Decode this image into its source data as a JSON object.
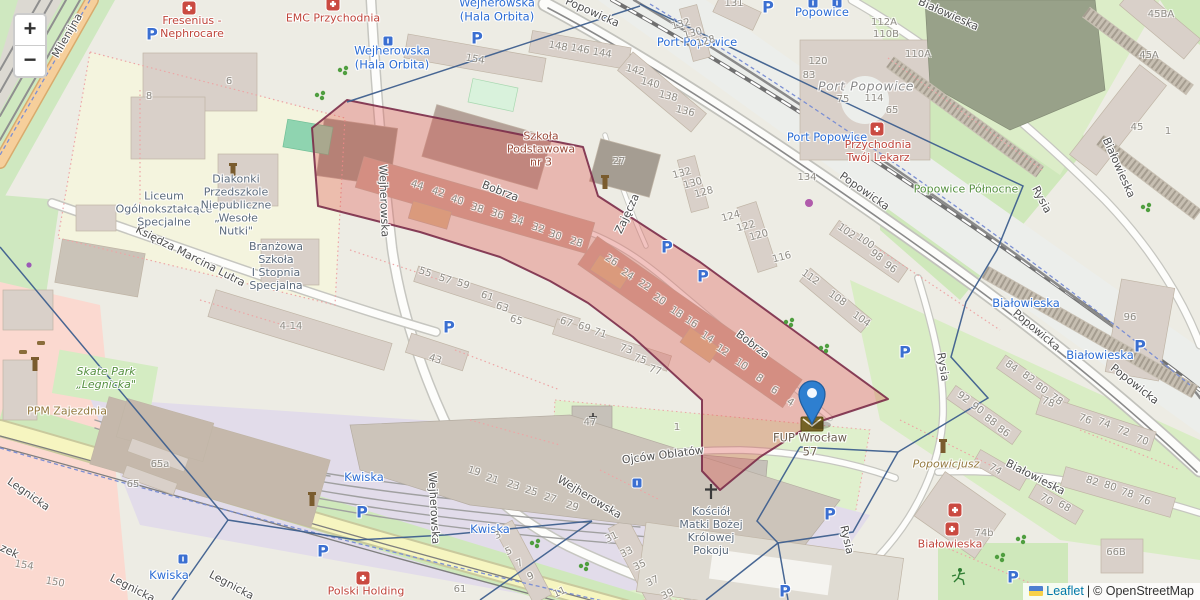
{
  "controls": {
    "zoom_in": "+",
    "zoom_out": "−"
  },
  "attribution": {
    "leaflet": "Leaflet",
    "separator": "|",
    "osm": "© OpenStreetMap"
  },
  "marker": {
    "label": "FUP Wrocław\n57",
    "x": 812,
    "y": 424
  },
  "colors": {
    "marker_blue": "#2e7fd0",
    "selection_fill": "#dd4f48",
    "selection_border": "#7b2c49",
    "zone_boundary": "#3e5f8e",
    "transit_blue": "#2b6cd4",
    "health_red": "#bf453b",
    "leaflet_link": "#0078A8"
  },
  "map": {
    "streets": [
      {
        "t": "Milenijna",
        "x": 68,
        "y": 36,
        "r": -60
      },
      {
        "t": "Wejherowska",
        "x": 383,
        "y": 201,
        "r": 88
      },
      {
        "t": "Wejherowska",
        "x": 433,
        "y": 508,
        "r": 87
      },
      {
        "t": "Wejherowska",
        "x": 589,
        "y": 498,
        "r": 31
      },
      {
        "t": "Księdza Marcina Lutra",
        "x": 190,
        "y": 257,
        "r": 27
      },
      {
        "t": "Bobrza",
        "x": 500,
        "y": 192,
        "r": 21
      },
      {
        "t": "Bobrza",
        "x": 752,
        "y": 345,
        "r": 37
      },
      {
        "t": "Zajęcza",
        "x": 628,
        "y": 214,
        "r": -65
      },
      {
        "t": "Popowicka",
        "x": 592,
        "y": 13,
        "r": 24
      },
      {
        "t": "Popowicka",
        "x": 864,
        "y": 192,
        "r": 35
      },
      {
        "t": "Popowicka",
        "x": 1036,
        "y": 331,
        "r": 40
      },
      {
        "t": "Popowicka",
        "x": 1134,
        "y": 385,
        "r": 38
      },
      {
        "t": "Białowieska",
        "x": 948,
        "y": 15,
        "r": 24
      },
      {
        "t": "Białowieska",
        "x": 1118,
        "y": 168,
        "r": 66
      },
      {
        "t": "Białowieska",
        "x": 1035,
        "y": 478,
        "r": 27
      },
      {
        "t": "Rysia",
        "x": 942,
        "y": 367,
        "r": 81
      },
      {
        "t": "Rysia",
        "x": 846,
        "y": 540,
        "r": 77
      },
      {
        "t": "Rysia",
        "x": 1041,
        "y": 200,
        "r": 62
      },
      {
        "t": "Ojców Oblatów",
        "x": 663,
        "y": 456,
        "r": -7
      },
      {
        "t": "Legnicka",
        "x": 28,
        "y": 495,
        "r": 35
      },
      {
        "t": "Legnicka",
        "x": 132,
        "y": 589,
        "r": 27
      },
      {
        "t": "Legnicka",
        "x": 231,
        "y": 586,
        "r": 28
      },
      {
        "t": "zek",
        "x": 9,
        "y": 552,
        "r": 25
      }
    ],
    "transit": [
      {
        "t": "Popowice",
        "x": 822,
        "y": 13
      },
      {
        "t": "Port Popowice",
        "x": 697,
        "y": 43
      },
      {
        "t": "Port Popowice",
        "x": 827,
        "y": 138
      },
      {
        "t": "Wejherowska\n(Hala Orbita)",
        "x": 392,
        "y": 58
      },
      {
        "t": "Wejherowska\n(Hala Orbita)",
        "x": 497,
        "y": 10
      },
      {
        "t": "Kwiska",
        "x": 364,
        "y": 478
      },
      {
        "t": "Kwiska",
        "x": 490,
        "y": 530
      },
      {
        "t": "Kwiska",
        "x": 169,
        "y": 576
      },
      {
        "t": "Białowieska",
        "x": 1026,
        "y": 304
      },
      {
        "t": "Białowieska",
        "x": 1100,
        "y": 356
      }
    ],
    "health": [
      {
        "t": "Fresenius -\nNephrocare",
        "x": 192,
        "y": 28
      },
      {
        "t": "EMC Przychodnia",
        "x": 333,
        "y": 19
      },
      {
        "t": "Przychodnia\nTwój Lekarz",
        "x": 878,
        "y": 152
      },
      {
        "t": "Polski Holding",
        "x": 366,
        "y": 592
      },
      {
        "t": "Białowieska",
        "x": 950,
        "y": 545
      }
    ],
    "education": [
      {
        "t": "Liceum\nOgólnokształcące\nSpecjalne",
        "x": 164,
        "y": 210
      },
      {
        "t": "Diakonki\nPrzedszkole\nNiepubliczne\n„Wesołe\nNutki\"",
        "x": 236,
        "y": 206
      },
      {
        "t": "Branżowa\nSzkoła\nI Stopnia\nSpecjalna",
        "x": 276,
        "y": 267
      }
    ],
    "places": [
      {
        "t": "Szkoła\nPodstawowa\nnr 3",
        "x": 541,
        "y": 150,
        "c": "edu-red"
      },
      {
        "t": "Kościół\nMatki Bożej\nKrólowej\nPokoju",
        "x": 711,
        "y": 532,
        "c": "edu"
      },
      {
        "t": "Port Popowice",
        "x": 866,
        "y": 87,
        "c": "hood",
        "i": 1
      },
      {
        "t": "Popowice Północne",
        "x": 966,
        "y": 190,
        "c": "green"
      },
      {
        "t": "Skate Park\n„Legnicka\"",
        "x": 106,
        "y": 379,
        "c": "green",
        "i": 1
      },
      {
        "t": "Popowicjusz",
        "x": 946,
        "y": 465,
        "c": "brown",
        "i": 1
      },
      {
        "t": "PPM Zajezdnia",
        "x": 67,
        "y": 412,
        "c": "brown"
      },
      {
        "t": "FUP Wrocław\n57",
        "x": 810,
        "y": 445,
        "c": "poi"
      }
    ],
    "numbers": [
      [
        "154",
        475,
        60,
        10
      ],
      [
        "148",
        558,
        47,
        10
      ],
      [
        "146",
        580,
        50,
        10
      ],
      [
        "144",
        602,
        54,
        10
      ],
      [
        "142",
        635,
        71,
        14
      ],
      [
        "140",
        650,
        84,
        14
      ],
      [
        "138",
        668,
        97,
        14
      ],
      [
        "136",
        685,
        112,
        14
      ],
      [
        "131",
        734,
        4,
        0
      ],
      [
        "132",
        681,
        25,
        -15
      ],
      [
        "130",
        693,
        34,
        -15
      ],
      [
        "128",
        706,
        42,
        -15
      ],
      [
        "132",
        682,
        174,
        -15
      ],
      [
        "130",
        693,
        184,
        -15
      ],
      [
        "128",
        704,
        193,
        -15
      ],
      [
        "124",
        731,
        217,
        -15
      ],
      [
        "122",
        746,
        227,
        -15
      ],
      [
        "120",
        759,
        236,
        -15
      ],
      [
        "116",
        782,
        258,
        -15
      ],
      [
        "112A",
        884,
        23,
        0
      ],
      [
        "110B",
        886,
        35,
        0
      ],
      [
        "110A",
        918,
        55,
        0
      ],
      [
        "120",
        818,
        62,
        0
      ],
      [
        "83",
        809,
        76,
        0
      ],
      [
        "75",
        843,
        100,
        0
      ],
      [
        "114",
        874,
        99,
        0
      ],
      [
        "65",
        892,
        111,
        0
      ],
      [
        "134",
        807,
        178,
        0
      ],
      [
        "27",
        619,
        162,
        0
      ],
      [
        "45BA",
        1161,
        15,
        0
      ],
      [
        "45A",
        1149,
        56,
        0
      ],
      [
        "45",
        1137,
        128,
        0
      ],
      [
        "1",
        1168,
        132,
        0
      ],
      [
        "44",
        417,
        186,
        18
      ],
      [
        "42",
        438,
        193,
        18
      ],
      [
        "40",
        457,
        201,
        18
      ],
      [
        "38",
        477,
        209,
        18
      ],
      [
        "36",
        497,
        215,
        18
      ],
      [
        "34",
        517,
        221,
        18
      ],
      [
        "32",
        538,
        229,
        18
      ],
      [
        "30",
        555,
        236,
        18
      ],
      [
        "28",
        576,
        243,
        18
      ],
      [
        "26",
        611,
        261,
        33
      ],
      [
        "24",
        627,
        275,
        33
      ],
      [
        "22",
        644,
        286,
        33
      ],
      [
        "20",
        659,
        300,
        33
      ],
      [
        "18",
        676,
        313,
        33
      ],
      [
        "16",
        691,
        323,
        33
      ],
      [
        "14",
        707,
        338,
        33
      ],
      [
        "12",
        722,
        351,
        33
      ],
      [
        "10",
        741,
        365,
        33
      ],
      [
        "8",
        759,
        379,
        33
      ],
      [
        "6",
        774,
        391,
        33
      ],
      [
        "4",
        790,
        403,
        33
      ],
      [
        "55",
        425,
        273,
        18
      ],
      [
        "57",
        445,
        280,
        18
      ],
      [
        "59",
        463,
        285,
        18
      ],
      [
        "61",
        487,
        297,
        18
      ],
      [
        "63",
        502,
        308,
        18
      ],
      [
        "65",
        516,
        321,
        18
      ],
      [
        "67",
        566,
        323,
        18
      ],
      [
        "69",
        584,
        328,
        18
      ],
      [
        "71",
        600,
        334,
        18
      ],
      [
        "73",
        626,
        350,
        18
      ],
      [
        "75",
        640,
        360,
        18
      ],
      [
        "77",
        655,
        371,
        18
      ],
      [
        "43",
        435,
        360,
        18
      ],
      [
        "4-14",
        291,
        327,
        0
      ],
      [
        "102",
        846,
        232,
        35
      ],
      [
        "100",
        865,
        242,
        35
      ],
      [
        "98",
        876,
        256,
        35
      ],
      [
        "96",
        890,
        268,
        35
      ],
      [
        "112",
        810,
        278,
        35
      ],
      [
        "108",
        837,
        299,
        35
      ],
      [
        "104",
        861,
        320,
        35
      ],
      [
        "47",
        590,
        423,
        0
      ],
      [
        "1",
        677,
        428,
        0
      ],
      [
        "19",
        474,
        472,
        17
      ],
      [
        "21",
        492,
        480,
        17
      ],
      [
        "23",
        513,
        486,
        17
      ],
      [
        "25",
        531,
        492,
        17
      ],
      [
        "27",
        550,
        499,
        17
      ],
      [
        "29",
        572,
        507,
        17
      ],
      [
        "31",
        612,
        538,
        -25
      ],
      [
        "33",
        627,
        553,
        -25
      ],
      [
        "35",
        640,
        566,
        -25
      ],
      [
        "37",
        653,
        582,
        -25
      ],
      [
        "39",
        668,
        595,
        -25
      ],
      [
        "3",
        498,
        536,
        -25
      ],
      [
        "5",
        509,
        552,
        -25
      ],
      [
        "7",
        520,
        564,
        -25
      ],
      [
        "9",
        531,
        577,
        -25
      ],
      [
        "11",
        560,
        593,
        -25
      ],
      [
        "92",
        963,
        398,
        35
      ],
      [
        "90",
        977,
        409,
        35
      ],
      [
        "88",
        990,
        421,
        35
      ],
      [
        "86",
        1003,
        432,
        35
      ],
      [
        "84",
        1011,
        367,
        35
      ],
      [
        "82",
        1028,
        378,
        35
      ],
      [
        "80",
        1041,
        389,
        35
      ],
      [
        "78",
        1056,
        400,
        35
      ],
      [
        "78",
        1048,
        403,
        20
      ],
      [
        "76",
        1085,
        420,
        20
      ],
      [
        "74",
        1104,
        424,
        20
      ],
      [
        "72",
        1123,
        432,
        20
      ],
      [
        "70",
        1142,
        441,
        20
      ],
      [
        "82",
        1092,
        482,
        18
      ],
      [
        "80",
        1110,
        487,
        18
      ],
      [
        "78",
        1127,
        494,
        18
      ],
      [
        "76",
        1144,
        501,
        18
      ],
      [
        "74",
        995,
        470,
        30
      ],
      [
        "70",
        1046,
        500,
        30
      ],
      [
        "68",
        1064,
        507,
        30
      ],
      [
        "74b",
        984,
        534,
        0
      ],
      [
        "66B",
        1116,
        553,
        0
      ],
      [
        "96",
        1130,
        318,
        0
      ],
      [
        "61",
        460,
        590,
        0
      ],
      [
        "65a",
        160,
        465,
        0
      ],
      [
        "65",
        133,
        485,
        0
      ],
      [
        "154",
        24,
        566,
        10
      ],
      [
        "150",
        55,
        583,
        10
      ],
      [
        "8",
        149,
        97,
        0
      ],
      [
        "6",
        229,
        82,
        0
      ]
    ],
    "parking_glyph": "P",
    "parking": [
      [
        152,
        35
      ],
      [
        477,
        39
      ],
      [
        768,
        8
      ],
      [
        667,
        248
      ],
      [
        703,
        277
      ],
      [
        449,
        328
      ],
      [
        905,
        353
      ],
      [
        1140,
        347
      ],
      [
        362,
        513
      ],
      [
        323,
        552
      ],
      [
        830,
        515
      ],
      [
        1013,
        578
      ],
      [
        785,
        592
      ]
    ],
    "icon_names": [
      "medical-cross-icon",
      "tram-stop-icon",
      "tree-icon",
      "tower-icon",
      "church-cross-icon",
      "shop-icon",
      "runner-icon",
      "car-icon",
      "post-office-envelope-icon",
      "marker-pin-icon"
    ]
  }
}
